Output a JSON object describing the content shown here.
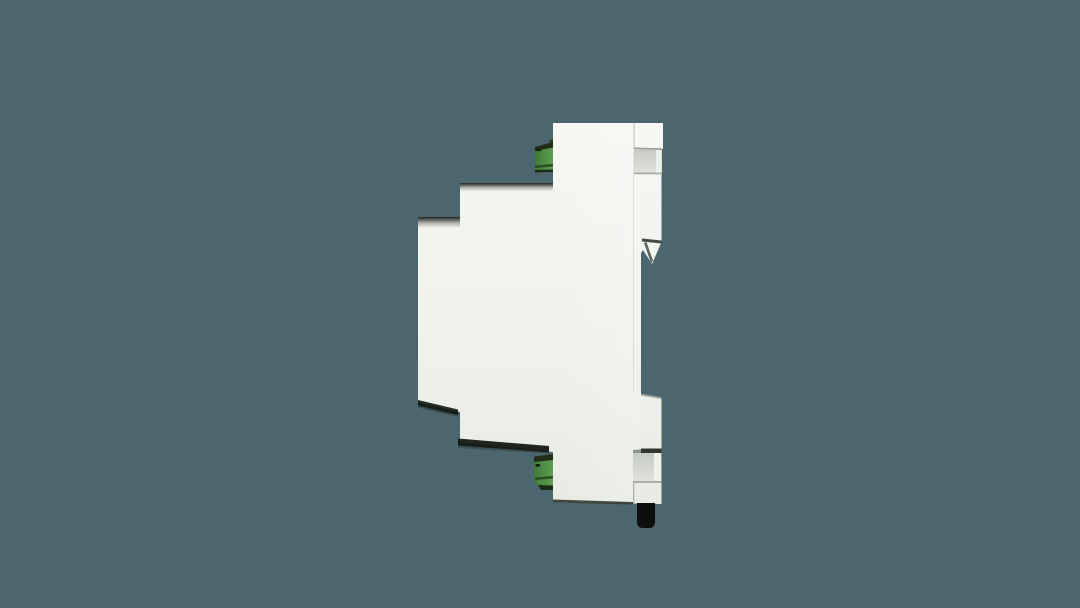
{
  "scene": {
    "subject": "white DIN-rail mount electronic module, side profile view",
    "parts": {
      "enclosure": "stepped white plastic enclosure",
      "top_terminal": "green screw terminal block (top)",
      "bottom_terminal": "green screw terminal block (bottom)",
      "din_hook": "DIN rail retaining hook",
      "din_notch_top": "DIN rail notch (upper)",
      "din_notch_bottom": "DIN rail notch (lower)",
      "release_clip": "black DIN rail release clip"
    }
  },
  "colors": {
    "background": "#4c666f",
    "body_top": "#f6f7f3",
    "body_mid": "#eff1ec",
    "body_bottom": "#e8ebe4",
    "bright": "#ffffff",
    "recess_top": "#c7ccc3",
    "recess_bottom": "#dfe2da",
    "recess_strip": "#eef0ea",
    "seam": "#c2c7bb",
    "ledge_line": "#9ba194",
    "notch_floor_line": "#a8aea0",
    "hook_edge": "#434a42",
    "hook_inner": "#60675f",
    "step_line": "#8d9387",
    "shadow_dark": "#141a13",
    "bottom_edge": "#30362e",
    "notch_dark_line": "#323830",
    "notch_side_line": "#8f958a",
    "clip_block": "#e9ece5",
    "clip_block_seam": "#aeb3a7",
    "terminal_top": "#222c18",
    "green_dark": "#3f7a37",
    "green_light": "#5f9f50",
    "terminal_stripe": "#27431f",
    "terminal_bottom": "#1c2b16",
    "terminal_mark": "#14200f",
    "terminal_corner": "#2e4a25",
    "release_clip": "#0d0f0c"
  }
}
